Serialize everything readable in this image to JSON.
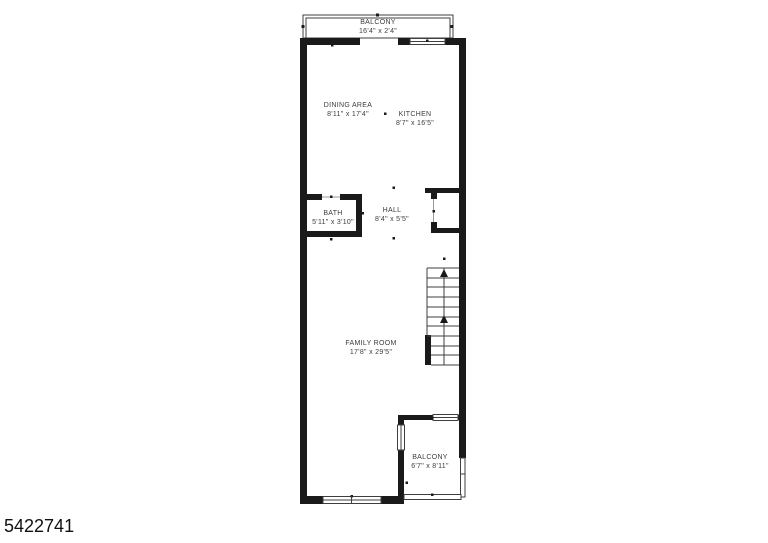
{
  "plan_id": "5422741",
  "rooms": [
    {
      "name": "BALCONY",
      "dims": "16'4\" x 2'4\""
    },
    {
      "name": "DINING AREA",
      "dims": "8'11\" x 17'4\""
    },
    {
      "name": "KITCHEN",
      "dims": "8'7\" x 16'5\""
    },
    {
      "name": "BATH",
      "dims": "5'11\" x 3'10\""
    },
    {
      "name": "HALL",
      "dims": "8'4\" x 5'5\""
    },
    {
      "name": "FAMILY ROOM",
      "dims": "17'8\" x 29'5\""
    },
    {
      "name": "BALCONY",
      "dims": "6'7\" x 8'11\""
    }
  ],
  "colors": {
    "wall": "#1a1a1a",
    "line": "#3f3f3f",
    "label": "#3d3d3d",
    "bg": "#ffffff",
    "id": "#111111"
  }
}
